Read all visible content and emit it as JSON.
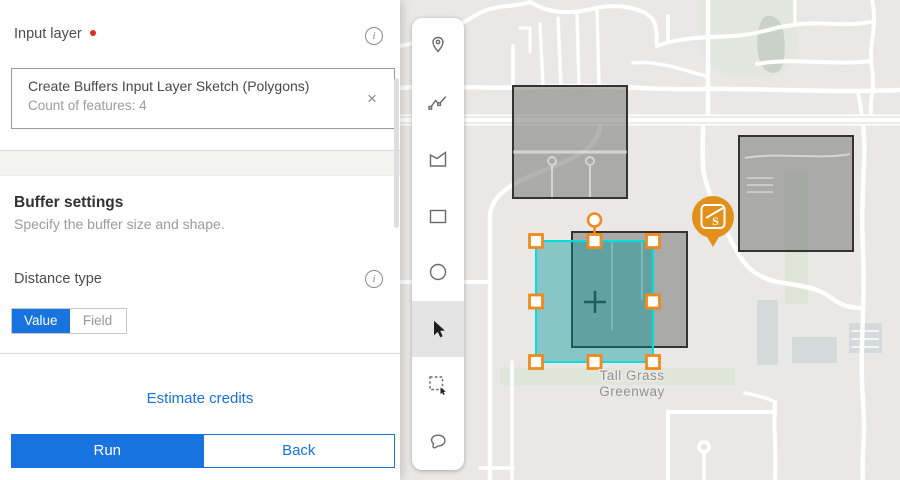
{
  "panel": {
    "input_layer": {
      "label": "Input layer",
      "required": true,
      "name": "Create Buffers Input Layer Sketch (Polygons)",
      "meta": "Count of features: 4"
    },
    "buffer": {
      "title": "Buffer settings",
      "subtitle": "Specify the buffer size and shape.",
      "distance_label": "Distance type",
      "options": [
        "Value",
        "Field"
      ],
      "selected_option": "Value"
    },
    "estimate_label": "Estimate credits",
    "run_label": "Run",
    "back_label": "Back"
  },
  "icons": {
    "info": "i",
    "clear": "×"
  },
  "toolbar": {
    "tools": [
      "point-tool",
      "polyline-tool",
      "polygon-tool",
      "rectangle-tool",
      "circle-tool",
      "select-tool",
      "select-by-rectangle-tool",
      "lasso-select-tool"
    ],
    "active_tool": "select-tool"
  },
  "map": {
    "label_line1": "Tall Grass",
    "label_line2": "Greenway",
    "marker_glyph": "S",
    "sketch_feature_count": 4
  },
  "colors": {
    "accent_blue": "#1673e0",
    "required_red": "#d83020",
    "selection_cyan": "#00dede",
    "handle_orange": "#ef8a1c",
    "marker_orange": "#e1901c",
    "sketch_teal": "rgba(0,150,150,0.42)",
    "map_background": "#e9e8e6"
  }
}
